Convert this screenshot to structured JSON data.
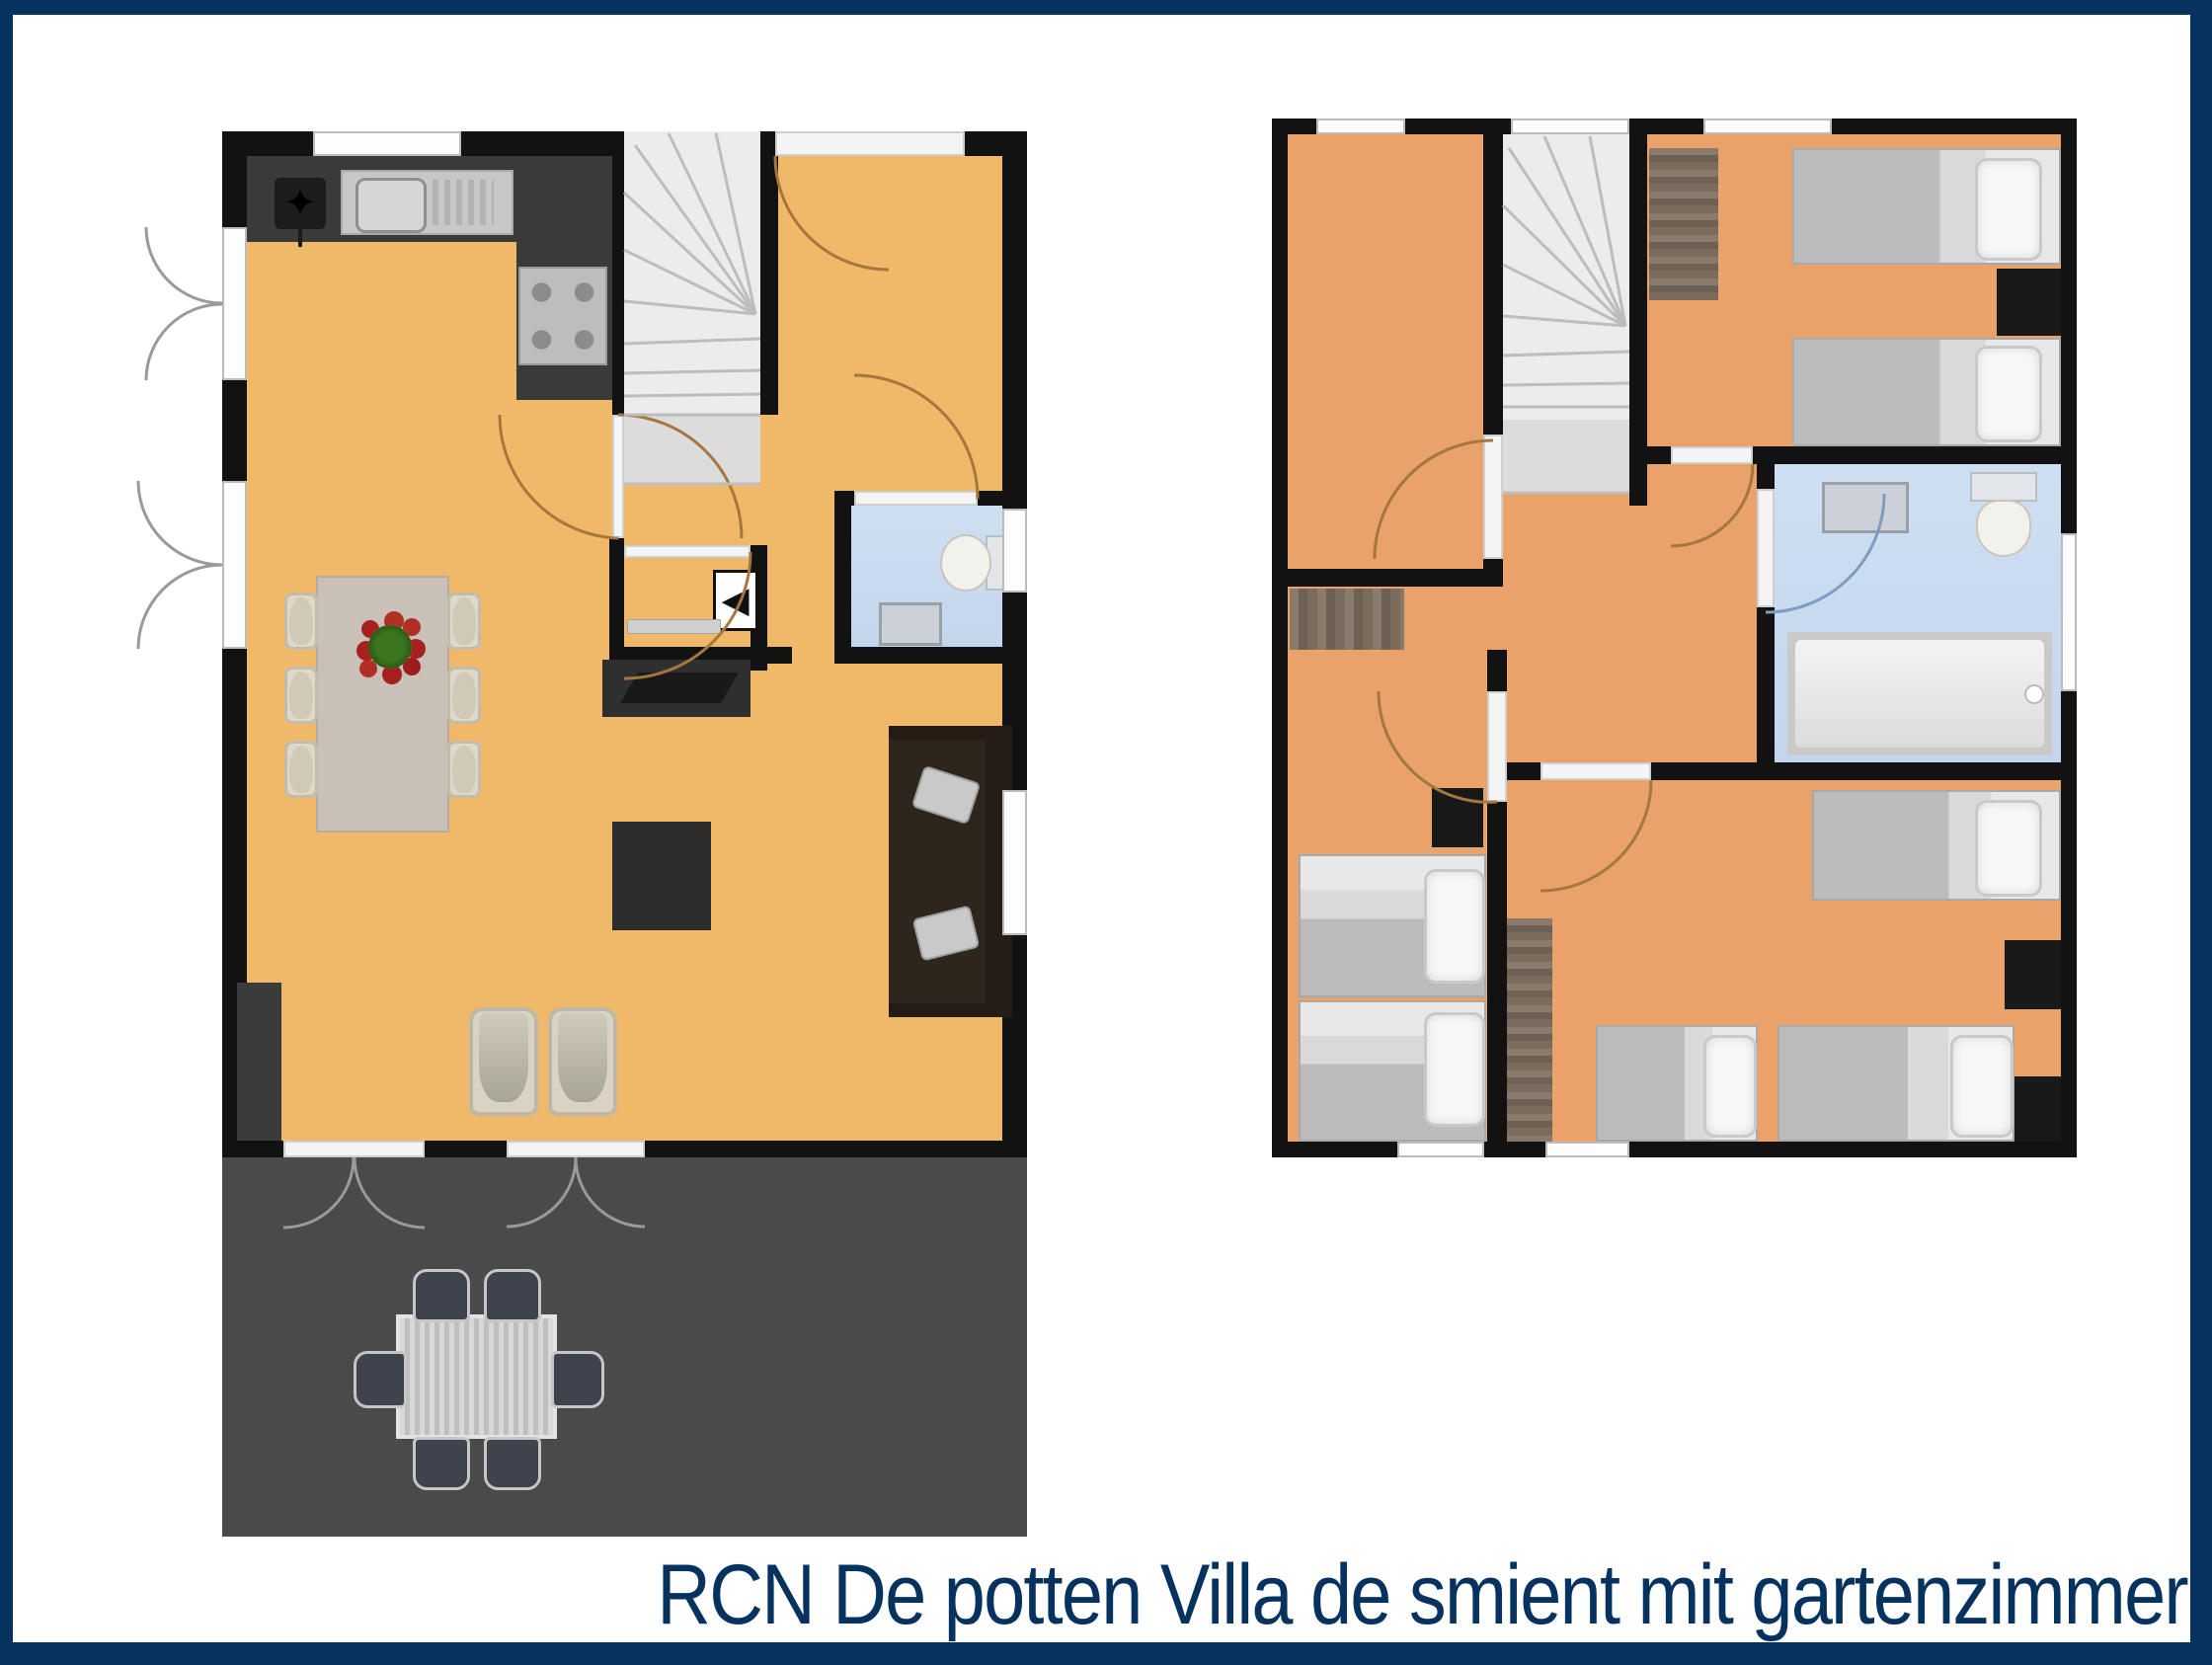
{
  "caption": {
    "text": "RCN De potten Villa de smient mit gartenzimmer"
  },
  "colors": {
    "frame_navy": "#05325f",
    "ground_floor": "#f0b869",
    "upper_floor": "#e8a26a",
    "wall_black": "#121212",
    "terrace_gray": "#4a4a4a",
    "bath_blue": "#cddcee",
    "counter_dark": "#3a3a3a",
    "stairs_gray": "#ececec",
    "wood_brown": "#7d6e60",
    "door_arc_brown": "#a5773f"
  },
  "icons": {
    "kitchen_lamp": "star-icon",
    "closet_appliance": "left-triangle-icon"
  },
  "glyphs": {
    "star": "✦",
    "appliance_arrow": "◀"
  },
  "plans": [
    {
      "id": "ground-floor",
      "side": "left",
      "rooms": [
        "kitchen-living-dining",
        "hall-stairs",
        "wc",
        "under-stairs-closet",
        "terrace"
      ]
    },
    {
      "id": "upper-floor",
      "side": "right",
      "rooms": [
        "bedroom-top-left",
        "bedroom-top-right",
        "bedroom-bottom-left",
        "bedroom-bottom-right",
        "bathroom",
        "landing-stairs"
      ]
    }
  ]
}
